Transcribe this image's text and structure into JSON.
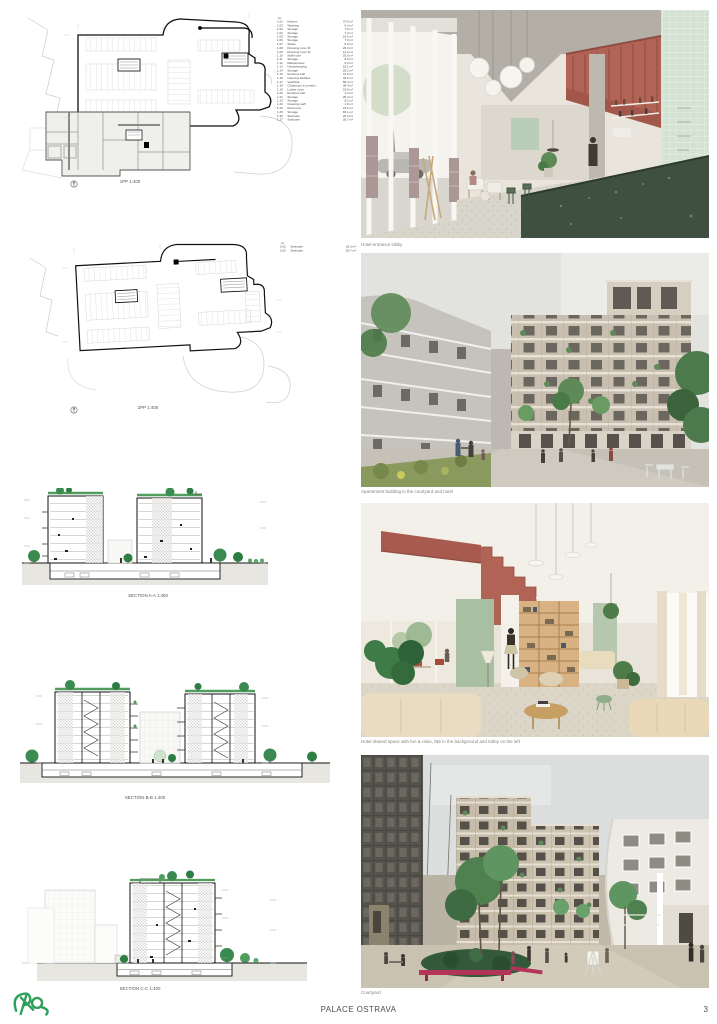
{
  "board": {
    "footer_title": "PALACE OSTRAVA",
    "page_number": "3"
  },
  "logo": {
    "name": "studio-logo",
    "color": "#2fa05a"
  },
  "plans": [
    {
      "caption": "1PP 1:400",
      "legend_header": "m²",
      "legend": [
        {
          "code": "1.01",
          "name": "Kitchen",
          "area": "37,5 m²"
        },
        {
          "code": "1.02",
          "name": "Washing",
          "area": "6,3 m²"
        },
        {
          "code": "1.03",
          "name": "Storage",
          "area": "7,5 m²"
        },
        {
          "code": "1.04",
          "name": "Storage",
          "area": "7,2 m²"
        },
        {
          "code": "1.05",
          "name": "Storage",
          "area": "10,5 m²"
        },
        {
          "code": "1.06",
          "name": "Storage",
          "area": "7,0 m²"
        },
        {
          "code": "1.07",
          "name": "Waste",
          "area": "8,3 m²"
        },
        {
          "code": "1.08",
          "name": "Dressing room M",
          "area": "20,3 m²"
        },
        {
          "code": "1.09",
          "name": "Dressing room W",
          "area": "12,2 m²"
        },
        {
          "code": "1.10",
          "name": "Staff room",
          "area": "25,0 m²"
        },
        {
          "code": "1.11",
          "name": "Storage",
          "area": "8,9 m²"
        },
        {
          "code": "1.12",
          "name": "Maintenance",
          "area": "9,3 m²"
        },
        {
          "code": "1.13",
          "name": "Housekeeping",
          "area": "19,1 m²"
        },
        {
          "code": "1.14",
          "name": "Storage",
          "area": "29,2 m²"
        },
        {
          "code": "1.15",
          "name": "Entrance hall",
          "area": "21,5 m²"
        },
        {
          "code": "1.16",
          "name": "Catering facilities",
          "area": "32,0 m²"
        },
        {
          "code": "1.17",
          "name": "Vestibule",
          "area": "58,3 m²"
        },
        {
          "code": "1.18",
          "name": "Cloakroom & corridor",
          "area": "35,4 m²"
        },
        {
          "code": "1.19",
          "name": "Locker room",
          "area": "23,9 m²"
        },
        {
          "code": "1.20",
          "name": "Entrance hall",
          "area": "4,4 m²"
        },
        {
          "code": "1.21",
          "name": "Storage",
          "area": "26,4 m²"
        },
        {
          "code": "1.22",
          "name": "Storage",
          "area": "8,2 m²"
        },
        {
          "code": "1.23",
          "name": "Cleaning staff",
          "area": "1,9 m²"
        },
        {
          "code": "1.24",
          "name": "Rest room",
          "area": "24,0 m²"
        },
        {
          "code": "1.25",
          "name": "Storage",
          "area": "65,1 m²"
        },
        {
          "code": "1.26",
          "name": "Staircase",
          "area": "20,3 m²"
        },
        {
          "code": "1.27",
          "name": "Staircase",
          "area": "20,7 m²"
        }
      ]
    },
    {
      "caption": "2PP 1:400",
      "legend_header": "m²",
      "legend": [
        {
          "code": "2.01",
          "name": "Staircase",
          "area": "20,3 m²"
        },
        {
          "code": "2.02",
          "name": "Staircase",
          "area": "20,7 m²"
        }
      ]
    }
  ],
  "sections": [
    {
      "caption": "SECTION A-A 1:400"
    },
    {
      "caption": "SECTION B-B 1:400"
    },
    {
      "caption": "SECTION C-C 1:400"
    }
  ],
  "renders": [
    {
      "caption": "Hotel entrance lobby"
    },
    {
      "caption": "Apartement building in the courtyard and hotel"
    },
    {
      "caption": "Hotel shared space with fun & relax, f&b in the background and lobby on the left"
    },
    {
      "caption": "Courtyard"
    }
  ],
  "colors": {
    "terracotta": "#b16455",
    "sage": "#a9bfa2",
    "mint": "#d3e2d2",
    "bar_green": "#3f4f40",
    "tree_green": "#3b8a4f",
    "logo_green": "#2fa05a"
  }
}
